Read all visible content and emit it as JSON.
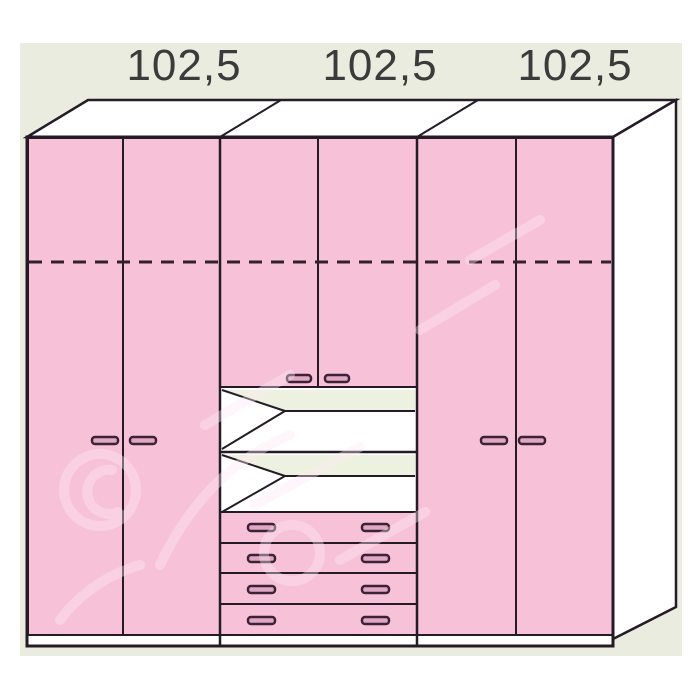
{
  "diagram": {
    "kind": "wardrobe-front-perspective-drawing",
    "dimension_labels": [
      "102,5",
      "102,5",
      "102,5"
    ],
    "sections": [
      {
        "width_label": "102,5",
        "doors": 2,
        "door_handles": 2,
        "internal_shelf_dashed_line": true
      },
      {
        "width_label": "102,5",
        "doors": 2,
        "door_handles": 2,
        "open_shelf_niches": 2,
        "drawers": 4,
        "drawer_handles": 8
      },
      {
        "width_label": "102,5",
        "doors": 2,
        "door_handles": 2,
        "internal_shelf_dashed_line": true
      }
    ]
  },
  "colors": {
    "door_pink": "#f7c2d8",
    "niche_back_cream": "#edf1df",
    "surface_white": "#ffffff",
    "background_panel": "#eaecdf",
    "outline": "#241b27",
    "handle_outline": "#3c2234",
    "handle_fill": "#dfa7c3",
    "label_text": "#3b3b3b"
  }
}
